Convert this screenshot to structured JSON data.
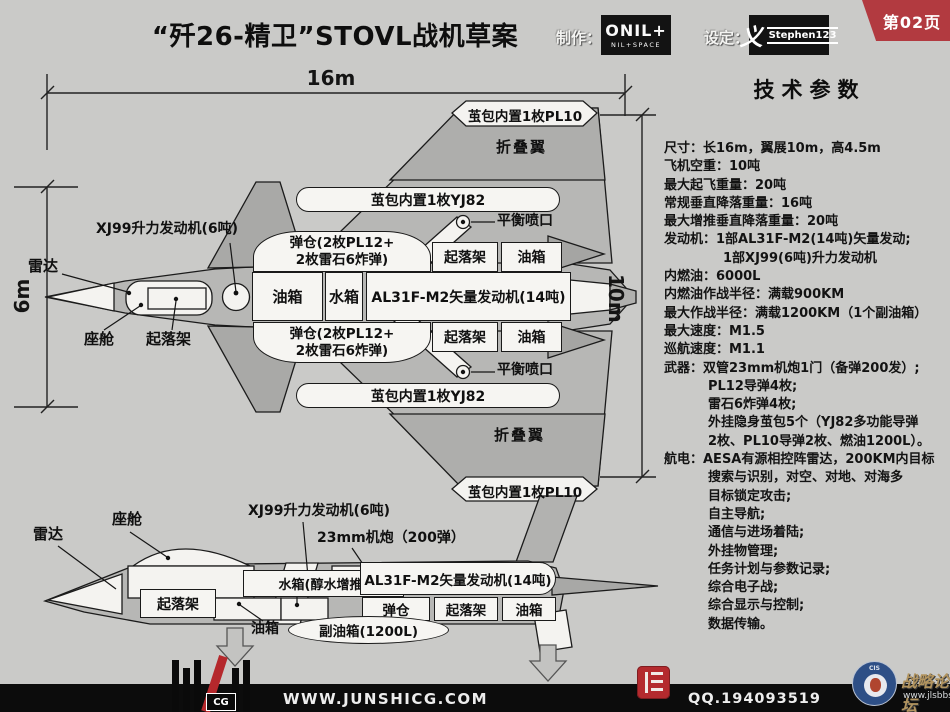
{
  "header": {
    "title": "“歼26-精卫”STOVL战机草案",
    "maker_label": "制作：",
    "maker_logo": "ONIL+",
    "maker_logo_sub": "NIL+SPACE",
    "designer_label": "设定：",
    "designer_glyph": "义",
    "designer_name": "Stephen123",
    "page_badge": "第02页"
  },
  "dims": {
    "length": "16m",
    "width": "6m",
    "span": "10m"
  },
  "top": {
    "radar": "雷达",
    "lift_engine": "XJ99升力发动机(6吨)",
    "cockpit": "座舱",
    "gear": "起落架",
    "bay1": "弹仓(2枚PL12+",
    "bay2": "2枚雷石6炸弹)",
    "fuel": "油箱",
    "water": "水箱",
    "engine": "AL31F-M2矢量发动机(14吨)",
    "balance": "平衡喷口",
    "yj82": "茧包内置1枚YJ82",
    "fold": "折叠翼",
    "pl10": "茧包内置1枚PL10"
  },
  "side": {
    "radar": "雷达",
    "cockpit": "座舱",
    "lift_engine": "XJ99升力发动机(6吨)",
    "cannon": "23mm机炮（200弹）",
    "water": "水箱(醇水增推)",
    "engine": "AL31F-M2矢量发动机(14吨)",
    "bay": "弹仓",
    "gear": "起落架",
    "fuel": "油箱",
    "drop_tank": "副油箱(1200L)"
  },
  "specs": {
    "title": "技术参数",
    "lines": [
      "尺寸：长16m，翼展10m，高4.5m",
      "飞机空重：10吨",
      "最大起飞重量：20吨",
      "常规垂直降落重量：16吨",
      "最大增推垂直降落重量：20吨",
      "发动机：1部AL31F-M2(14吨)矢量发动;",
      "1部XJ99(6吨)升力发动机",
      "内燃油：6000L",
      "内燃油作战半径：满载900KM",
      "最大作战半径：满载1200KM（1个副油箱）",
      "最大速度：M1.5",
      "巡航速度：M1.1",
      "武器：双管23mm机炮1门（备弹200发）;",
      "PL12导弹4枚;",
      "雷石6炸弹4枚;",
      "外挂隐身茧包5个（YJ82多功能导弹",
      "2枚、PL10导弹2枚、燃油1200L）。",
      "航电：AESA有源相控阵雷达，200KM内目标",
      "搜索与识别，对空、对地、对海多",
      "目标锁定攻击;",
      "自主导航;",
      "通信与进场着陆;",
      "外挂物管理;",
      "任务计划与参数记录;",
      "综合电子战;",
      "综合显示与控制;",
      "数据传输。"
    ]
  },
  "footer": {
    "site": "WWW.JUNSHICG.COM",
    "qq": "QQ.194093519",
    "cg": "CG",
    "cis_label": "CIS",
    "forum": "战略论坛",
    "forum_url": "www.jlsbbs.com"
  },
  "colors": {
    "accent_red": "#b23a40",
    "bg": "#cacac8",
    "aircraft_gray": "#b7b7b5",
    "panel_white": "#f4f3f0",
    "bar_black": "#0c0c0c"
  }
}
